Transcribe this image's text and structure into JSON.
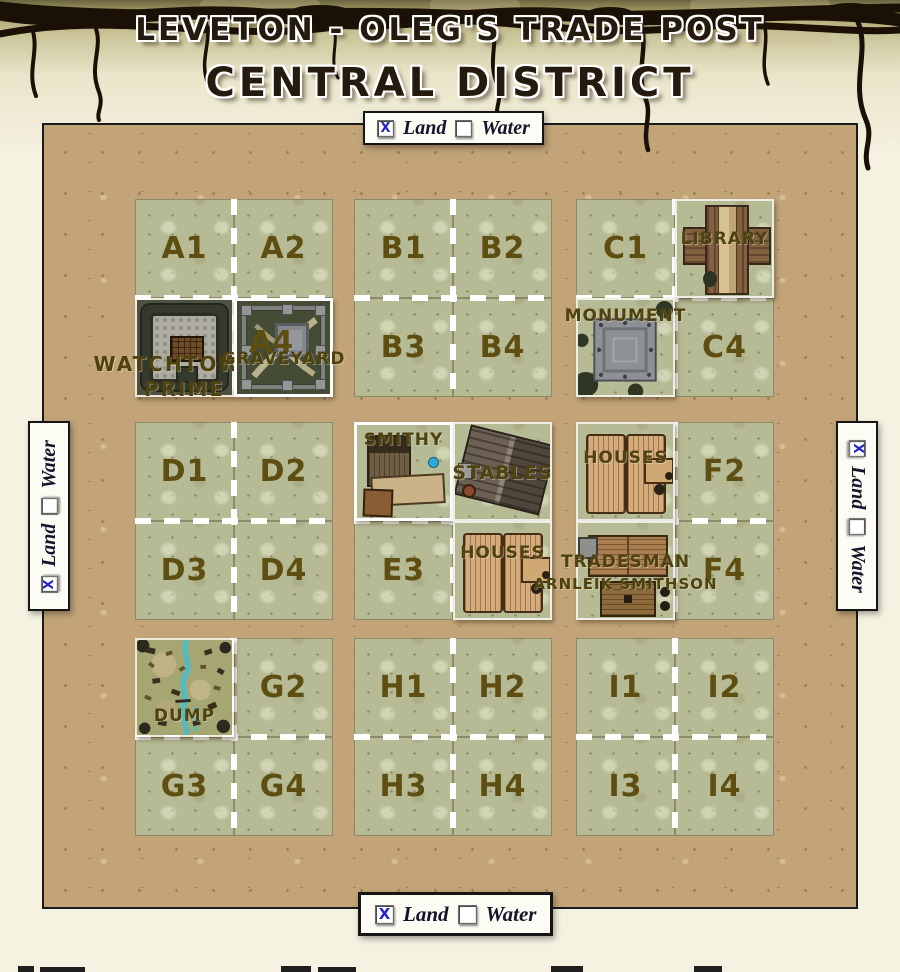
{
  "header": {
    "title": "LEVETON - OLEG'S TRADE POST",
    "subtitle": "CENTRAL DISTRICT"
  },
  "toggle": {
    "land": "Land",
    "water": "Water",
    "land_checked": true,
    "water_checked": false,
    "checked_glyph": "X"
  },
  "map": {
    "blocks": [
      {
        "id": "A",
        "quadrants": [
          {
            "label": "A1",
            "type": "grass"
          },
          {
            "label": "A2",
            "type": "grass"
          },
          {
            "type": "building",
            "building": "watchtower",
            "caption1": "WATCHTOWER",
            "caption2": "PRIME"
          },
          {
            "label": "A4",
            "type": "building",
            "building": "graveyard",
            "caption1": "GRAVEYARD",
            "selected": true
          }
        ]
      },
      {
        "id": "B",
        "quadrants": [
          {
            "label": "B1",
            "type": "grass"
          },
          {
            "label": "B2",
            "type": "grass"
          },
          {
            "label": "B3",
            "type": "grass"
          },
          {
            "label": "B4",
            "type": "grass"
          }
        ]
      },
      {
        "id": "C",
        "quadrants": [
          {
            "label": "C1",
            "type": "grass"
          },
          {
            "type": "building",
            "building": "library",
            "caption1": "LIBRARY"
          },
          {
            "type": "building",
            "building": "monument",
            "caption1": "MONUMENT"
          },
          {
            "label": "C4",
            "type": "grass"
          }
        ]
      },
      {
        "id": "D",
        "quadrants": [
          {
            "label": "D1",
            "type": "grass"
          },
          {
            "label": "D2",
            "type": "grass"
          },
          {
            "label": "D3",
            "type": "grass"
          },
          {
            "label": "D4",
            "type": "grass"
          }
        ]
      },
      {
        "id": "E",
        "quadrants": [
          {
            "type": "building",
            "building": "smithy",
            "caption1": "SMITHY",
            "selected": true
          },
          {
            "type": "building",
            "building": "stables",
            "caption1": "STABLES"
          },
          {
            "label": "E3",
            "type": "grass"
          },
          {
            "type": "building",
            "building": "houses",
            "caption1": "HOUSES"
          }
        ]
      },
      {
        "id": "F",
        "quadrants": [
          {
            "type": "building",
            "building": "houses",
            "caption1": "HOUSES"
          },
          {
            "label": "F2",
            "type": "grass"
          },
          {
            "type": "building",
            "building": "tradesman",
            "caption1": "TRADESMAN",
            "caption2": "ARNLEIK SMITHSON"
          },
          {
            "label": "F4",
            "type": "grass"
          }
        ]
      },
      {
        "id": "G",
        "quadrants": [
          {
            "type": "building",
            "building": "dump",
            "caption1": "DUMP"
          },
          {
            "label": "G2",
            "type": "grass"
          },
          {
            "label": "G3",
            "type": "grass"
          },
          {
            "label": "G4",
            "type": "grass"
          }
        ]
      },
      {
        "id": "H",
        "quadrants": [
          {
            "label": "H1",
            "type": "grass"
          },
          {
            "label": "H2",
            "type": "grass"
          },
          {
            "label": "H3",
            "type": "grass"
          },
          {
            "label": "H4",
            "type": "grass"
          }
        ]
      },
      {
        "id": "I",
        "quadrants": [
          {
            "label": "I1",
            "type": "grass"
          },
          {
            "label": "I2",
            "type": "grass"
          },
          {
            "label": "I3",
            "type": "grass"
          },
          {
            "label": "I4",
            "type": "grass"
          }
        ]
      }
    ]
  },
  "icons": {
    "checkbox_checked": "checkbox-checked-x",
    "checkbox_unchecked": "checkbox-unchecked"
  },
  "colors": {
    "check_blue": "#2323cc",
    "dash_white": "#ffffff",
    "tile_label_olive": "#5e4e12",
    "street_tan": "#c2a478",
    "grass_green": "#b7bb95"
  }
}
